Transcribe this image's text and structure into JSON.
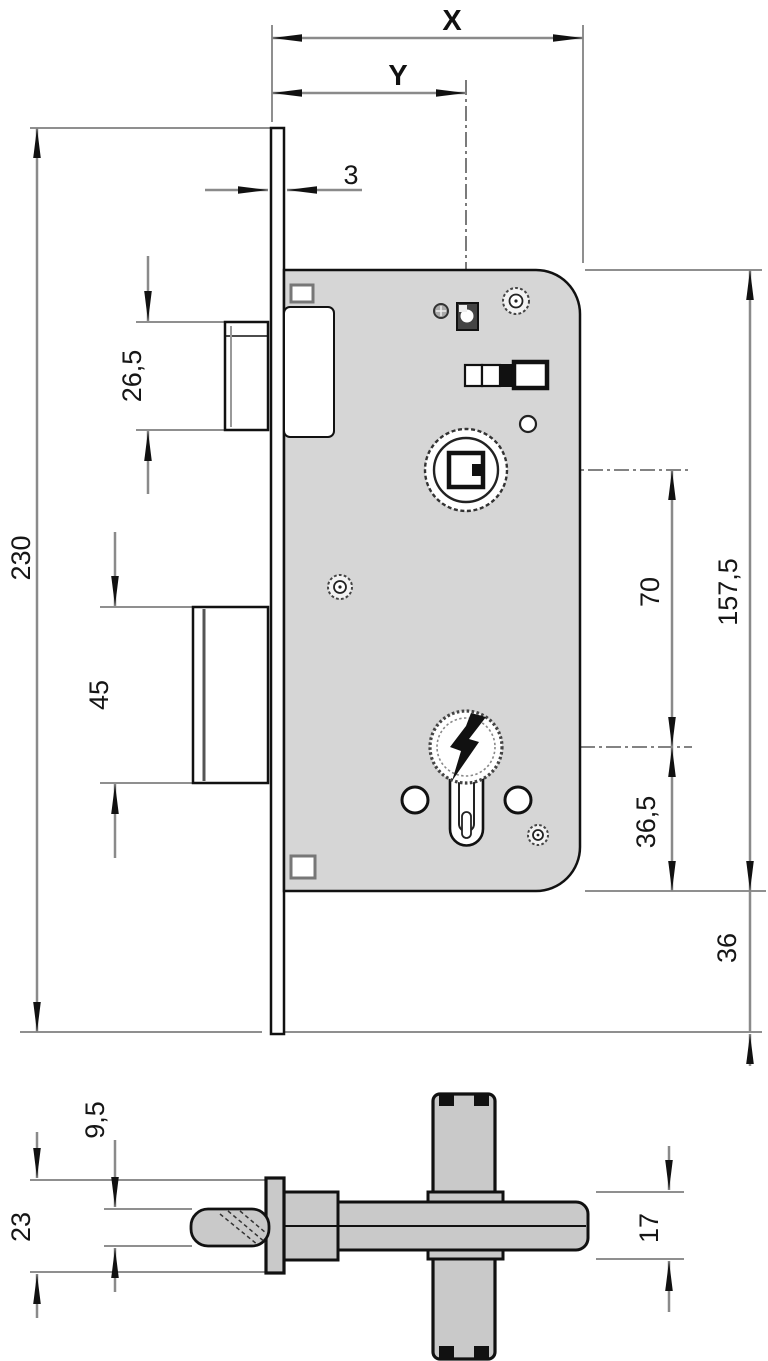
{
  "diagram": {
    "type": "technical-drawing",
    "subject": "mortise-lock-dimensions",
    "views": [
      "front-view",
      "bottom-view"
    ],
    "units": "mm",
    "colors": {
      "body_fill": "#d6d6d6",
      "bottom_view_fill": "#c9c9c9",
      "line": "#111111",
      "dimension_line": "#8a8a8a"
    }
  },
  "labels": {
    "x": "X",
    "y": "Y",
    "plate_thickness": "3",
    "total_height": "230",
    "latch_bolt_height": "26,5",
    "deadbolt_height": "45",
    "hub_to_cylinder": "70",
    "case_height": "157,5",
    "cylinder_to_case_bottom": "36,5",
    "case_bottom_to_plate_end": "36",
    "latch_depth": "9,5",
    "plate_width": "23",
    "case_thickness": "17"
  }
}
